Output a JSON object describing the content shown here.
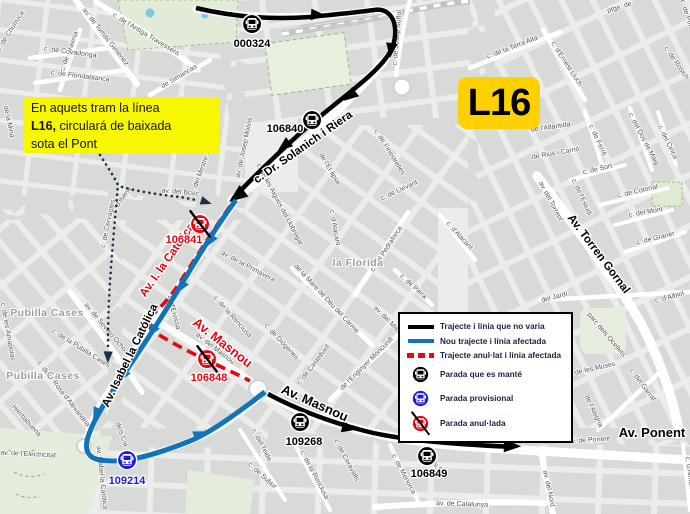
{
  "annotation": {
    "line1": "En aquets tram la línea",
    "bold": "L16,",
    "line2": " circulará de baixada",
    "line3": "sota el Pont"
  },
  "badge": {
    "label": "L16"
  },
  "legend": {
    "items": [
      {
        "icon": "black-line-swatch",
        "label": "Trajecte i línia que no varia"
      },
      {
        "icon": "blue-line-swatch",
        "label": "Nou trajecte i línia afectada"
      },
      {
        "icon": "red-dashed-line-swatch",
        "label": "Trajecte anul·lat i línia afectada"
      },
      {
        "icon": "black-bus-stop-icon",
        "label": "Parada que es manté"
      },
      {
        "icon": "blue-bus-stop-icon",
        "label": "Parada provisional"
      },
      {
        "icon": "red-crossed-bus-stop-icon",
        "label": "Parada anul·lada"
      }
    ]
  },
  "stops": [
    {
      "id": "000324",
      "status": "kept"
    },
    {
      "id": "106840",
      "status": "kept"
    },
    {
      "id": "106841",
      "status": "cancelled"
    },
    {
      "id": "106848",
      "status": "cancelled"
    },
    {
      "id": "109214",
      "status": "provisional"
    },
    {
      "id": "109268",
      "status": "kept"
    },
    {
      "id": "106849",
      "status": "kept"
    }
  ],
  "colors": {
    "route_unchanged": "#000000",
    "route_new": "#1274b8",
    "route_cancelled": "#e30613",
    "stop_provisional": "#1f1bd6",
    "note_background": "#f7f700",
    "badge_background": "#fdd000"
  },
  "map": {
    "place_labels": [
      "la Florida",
      "Pubilla Cases",
      "Pubilla Cases"
    ],
    "route_names": [
      "c. Dr. Solanich i Riera",
      "Av. Isabel la Católica",
      "Av. I. la Católica",
      "Av. Masnou",
      "Av. Masnou",
      "Av. Torren Gornal",
      "Av. Ponent"
    ],
    "street_labels": [
      "c. de Churruca",
      "c. de Gravina",
      "av. de Tomás Giménez",
      "c. de l'Antiga Travessera",
      "c. de Covadonga",
      "c. de Floridablanca",
      "de Simancas",
      "c. de Josep Suñol",
      "c. de la Terra Alta",
      "c. d'Ernest Lluch",
      "ptge. de",
      "c. de Potosí",
      "c. de Rosich",
      "de l'Atlàntida",
      "de Rius i Carrió",
      "c. de Ferré",
      "c. del Dos de Maig",
      "c. del Cinca",
      "c. de Sort",
      "c. de l'Estudi",
      "c. de Cotonat",
      "c. del Mont",
      "c. de Graner",
      "av. del Torrent",
      "del Jardí",
      "c. d'Albiol",
      "parc dels Ocellets",
      "c. de les Muses",
      "c. del Garraf",
      "de l'Alegria",
      "av. de Ponent",
      "av. del Nord",
      "av. de Catalunya",
      "c. d'Almeria",
      "c. de Menorca",
      "c. dels Pins",
      "c. del Teide",
      "c. de Subur",
      "c. de la Renclusa",
      "c. de Ceravalls",
      "de l'Enginyer Moncunill",
      "c. de Castellvell",
      "c. de Diógenes",
      "de la Mare de Déu del Carme",
      "av. del Masnou",
      "av. del Masnou",
      "c. de la Renclusa",
      "c. d'Eivissa",
      "av. de la Primavera",
      "c. de Cervantes",
      "c. d'Ibéria",
      "av. del Bosc",
      "c. del Mestre Serrano",
      "av. de Josep Molins",
      "c. de les Aigues del Llobregat",
      "de l'El·lipse",
      "c. de Finestrelles",
      "c. de Llevant",
      "c. de Piera",
      "c. del Pedraforca",
      "c. d'Alacant",
      "c. d'Alacant",
      "c. de la Pubilla Cases",
      "av. de Severo Ochoa",
      "c. de les Amapolas",
      "c. de la Rosa d'Alexandria",
      "Hierbabuena",
      "av. de l'Electricitat",
      "av. Isabel la Católica",
      "dels Cla",
      "de la Mina"
    ]
  }
}
